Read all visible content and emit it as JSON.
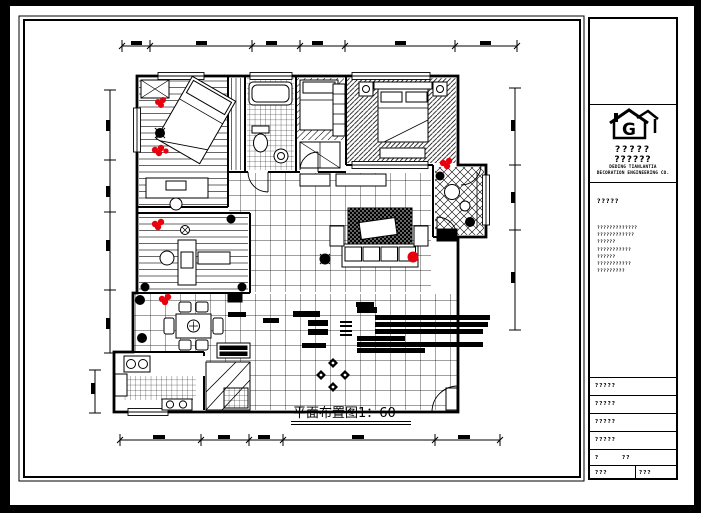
{
  "colors": {
    "canvas_bg": "#000000",
    "paper": "#ffffff",
    "ink": "#000000",
    "accent_red": "#e8000d"
  },
  "drawing": {
    "caption": "平面布置图1：60",
    "scale": "1：60",
    "compass_icon": "compass-rose",
    "legend_icon": "notes-text-block"
  },
  "title_block": {
    "logo_icon": "house-g-logo",
    "logo_text_line1": "?????",
    "logo_text_line2": "??????",
    "company_line1": "DEDING TIANLANTIA",
    "company_line2": "DECORATION ENGINEERING CO.",
    "project_section": {
      "label": "?????",
      "lines": [
        "?????????????",
        "????????????",
        "??????",
        "???????????",
        "??????",
        "???????????",
        "?????????"
      ]
    },
    "info_rows": [
      "?????",
      "?????",
      "?????",
      "?????"
    ],
    "scale_row": {
      "label": "?",
      "value": "??"
    },
    "footer_row": {
      "left": "???",
      "right": "???"
    }
  }
}
